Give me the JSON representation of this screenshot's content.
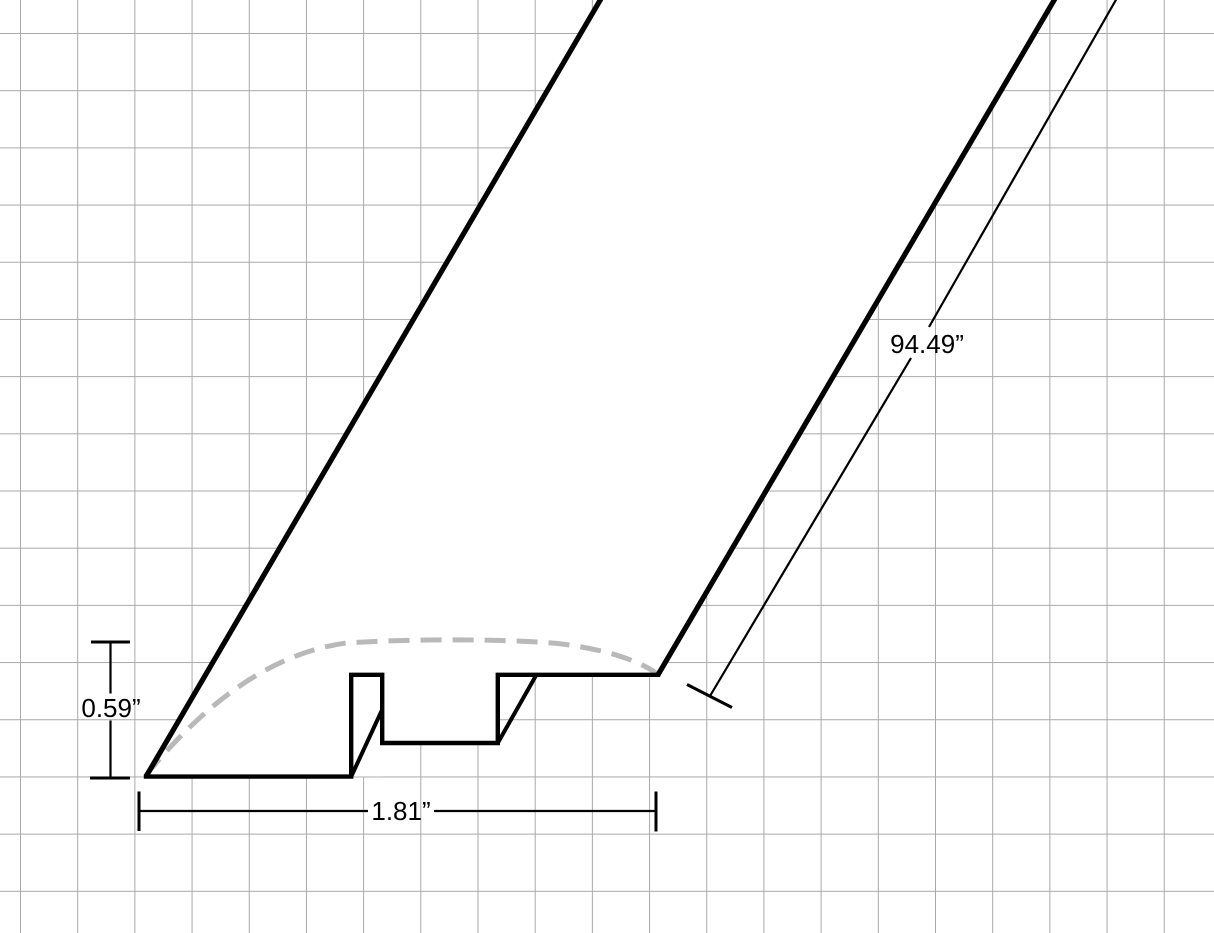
{
  "drawing": {
    "type": "molding-profile-technical-drawing",
    "description": "Pseudo-3D blueprint of a flooring transition molding strip on grid paper: cross-section profile at lower left, length extruded toward upper right, dashed curve showing rounded top surface",
    "dimension_labels": {
      "height": "0.59”",
      "width": "1.81”",
      "length": "94.49”"
    },
    "dimension_values_inches": {
      "height": 0.59,
      "width": 1.81,
      "length": 94.49
    },
    "colors": {
      "line": "#000000",
      "grid_line": "#a9a9a9",
      "hidden_curve": "#b9b9b9",
      "background": "#ffffff"
    }
  }
}
